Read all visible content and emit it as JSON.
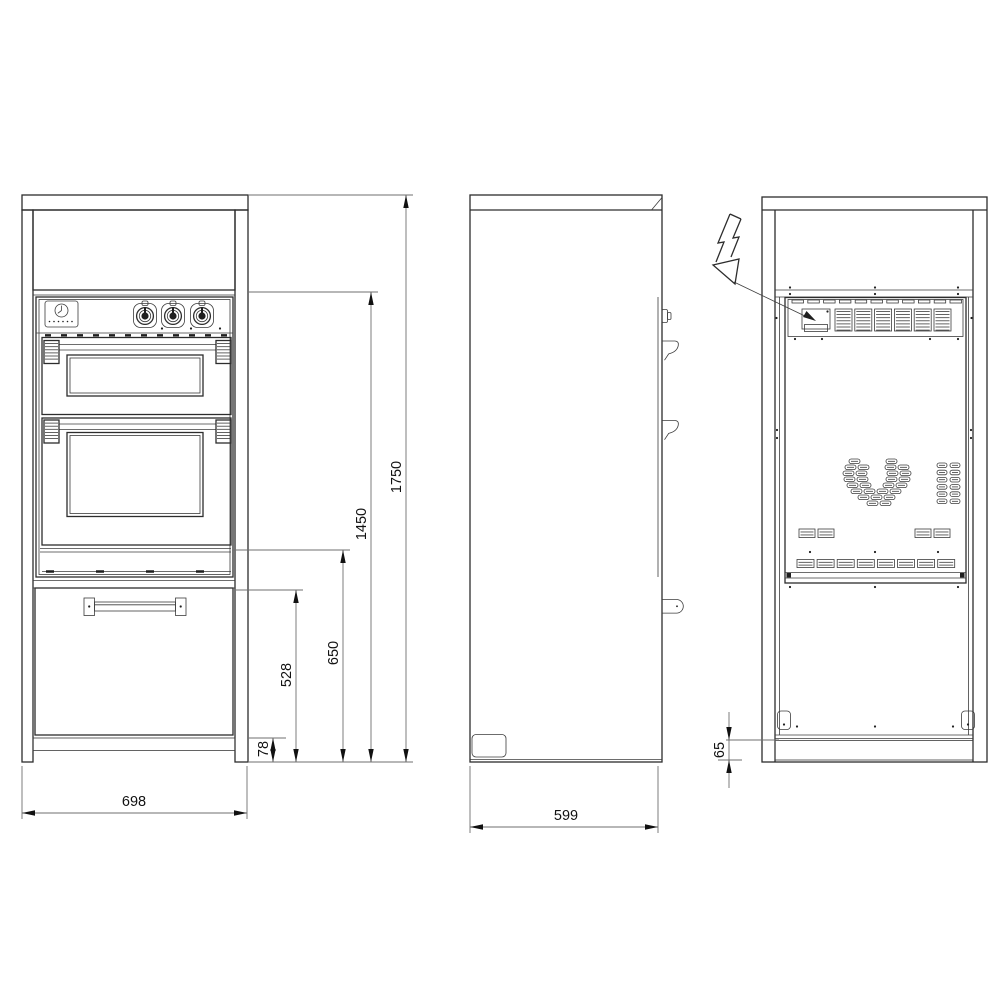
{
  "dimensions": {
    "front_width": "698",
    "height_total": "1750",
    "height_to_control_panel": "1450",
    "height_to_oven_bottom": "650",
    "height_to_drawer_top": "528",
    "front_plinth_height": "78",
    "depth": "599",
    "rear_plinth_height": "65"
  },
  "icons": {
    "electrical_connection": "lightning-bolt-arrow"
  },
  "colors": {
    "line": "#2d2d2d",
    "dimension_line": "#6f6f6f",
    "background": "#ffffff"
  }
}
